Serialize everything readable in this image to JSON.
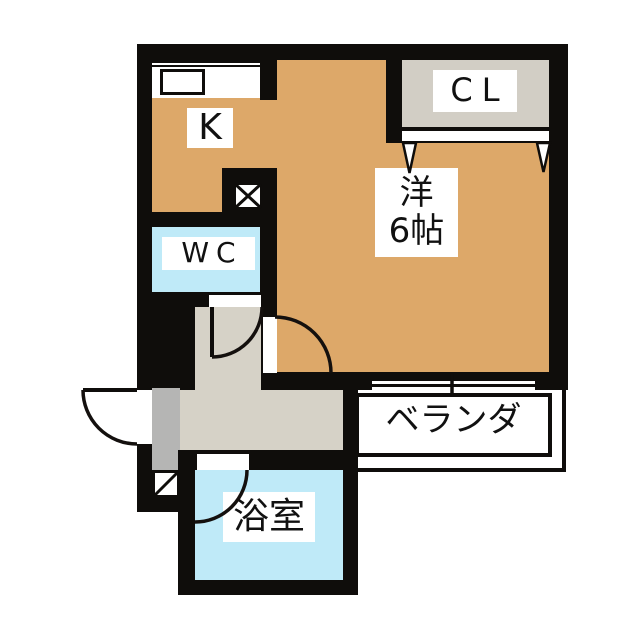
{
  "plan": {
    "type": "apartment-floor-plan",
    "rooms": {
      "kitchen": {
        "label": "K"
      },
      "closet": {
        "label": "CL"
      },
      "western_room": {
        "label": "洋",
        "size": "6帖"
      },
      "toilet": {
        "label": "WC"
      },
      "veranda": {
        "label": "ベランダ"
      },
      "bathroom": {
        "label": "浴室"
      }
    },
    "colors": {
      "wall": "#0f0d0b",
      "room_floor": "#dda869",
      "wet_area": "#bfeaf8",
      "closet": "#d2cec5",
      "hallway": "#d6d2c7",
      "entry_step": "#b5b5b4",
      "background": "#ffffff"
    }
  }
}
